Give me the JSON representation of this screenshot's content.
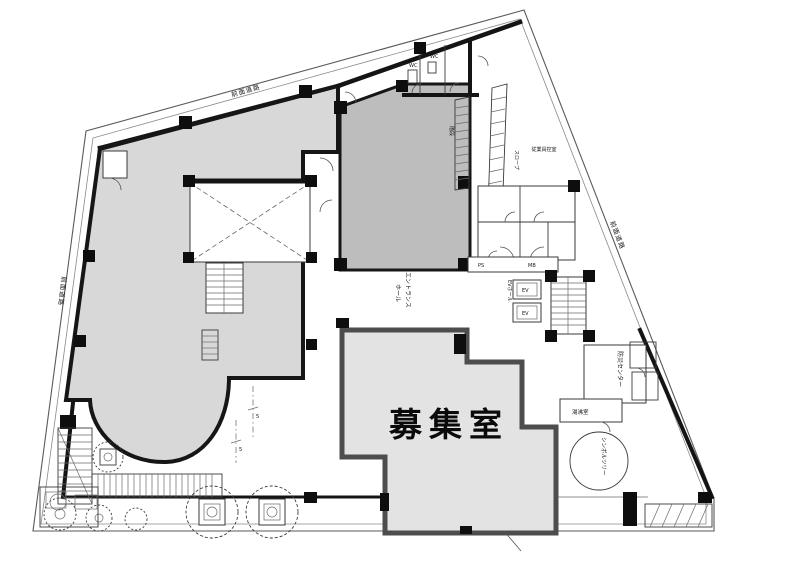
{
  "colors": {
    "left_tenant": "#d8d8d8",
    "center_tenant": "#bdbdbd",
    "vacant_room": "#e3e3e3",
    "vacant_border": "#4d4d4d",
    "wall": "#141414"
  },
  "rooms": {
    "vacant_label": "募集室",
    "entrance_line1": "エントランス",
    "entrance_line2": "ホール",
    "disaster_center": "防災センター",
    "kitchenette": "湯沸室",
    "staff_room": "従業員控室",
    "stair": "階段",
    "ramp": "スロープ",
    "ev": "EV",
    "ev_hall": "EVホール",
    "ps": "PS",
    "mb": "MB",
    "wc_a": "WC",
    "wc_b": "WC",
    "symbol_tree": "シンボルツリー"
  },
  "streets": {
    "top": "前面道路",
    "left": "前面道路",
    "right": "前面道路"
  },
  "markers": {
    "m1": "5",
    "m2": "5"
  }
}
